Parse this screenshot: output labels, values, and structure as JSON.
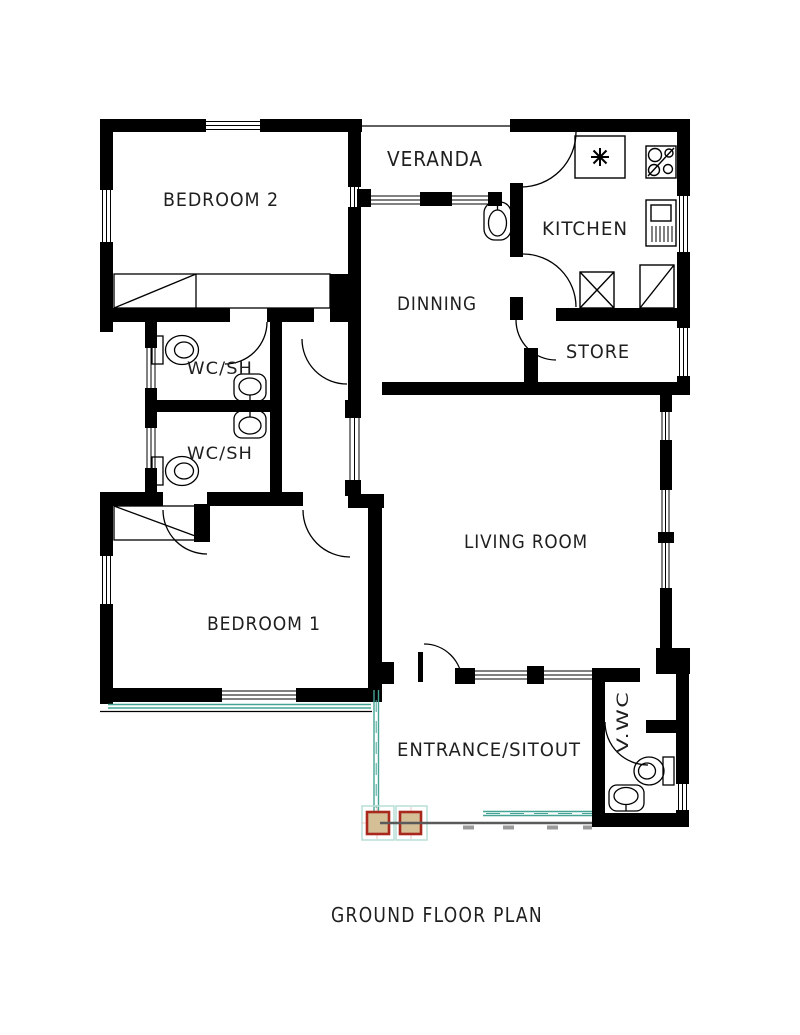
{
  "title": "GROUND FLOOR PLAN",
  "rooms": [
    {
      "name": "veranda",
      "label": "VERANDA"
    },
    {
      "name": "bedroom-2",
      "label": "BEDROOM 2"
    },
    {
      "name": "kitchen",
      "label": "KITCHEN"
    },
    {
      "name": "dinning",
      "label": "DINNING"
    },
    {
      "name": "store",
      "label": "STORE"
    },
    {
      "name": "wc-shower-upper",
      "label": "WC/SH"
    },
    {
      "name": "wc-shower-lower",
      "label": "WC/SH"
    },
    {
      "name": "living-room",
      "label": "LIVING ROOM"
    },
    {
      "name": "bedroom-1",
      "label": "BEDROOM 1"
    },
    {
      "name": "entrance-sitout",
      "label": "ENTRANCE/SITOUT"
    },
    {
      "name": "veranda-wc",
      "label": "V.WC"
    }
  ],
  "fixtures": [
    "stove-icon",
    "kitchen-sink-icon",
    "refrigerator-icon",
    "washing-machine-icon",
    "corner-counter-icon",
    "wash-basin-icon",
    "toilet-icon",
    "wardrobe-icon"
  ],
  "colors": {
    "wall": "#000000",
    "label": "#1f1f1f",
    "railing_teal": "#45a495",
    "railing_light": "#b9ddd6",
    "column_fill": "#d5bf97",
    "column_border": "#a8281e",
    "ground_line": "#5a5a5a",
    "ground_tick": "#9a9a9a"
  }
}
